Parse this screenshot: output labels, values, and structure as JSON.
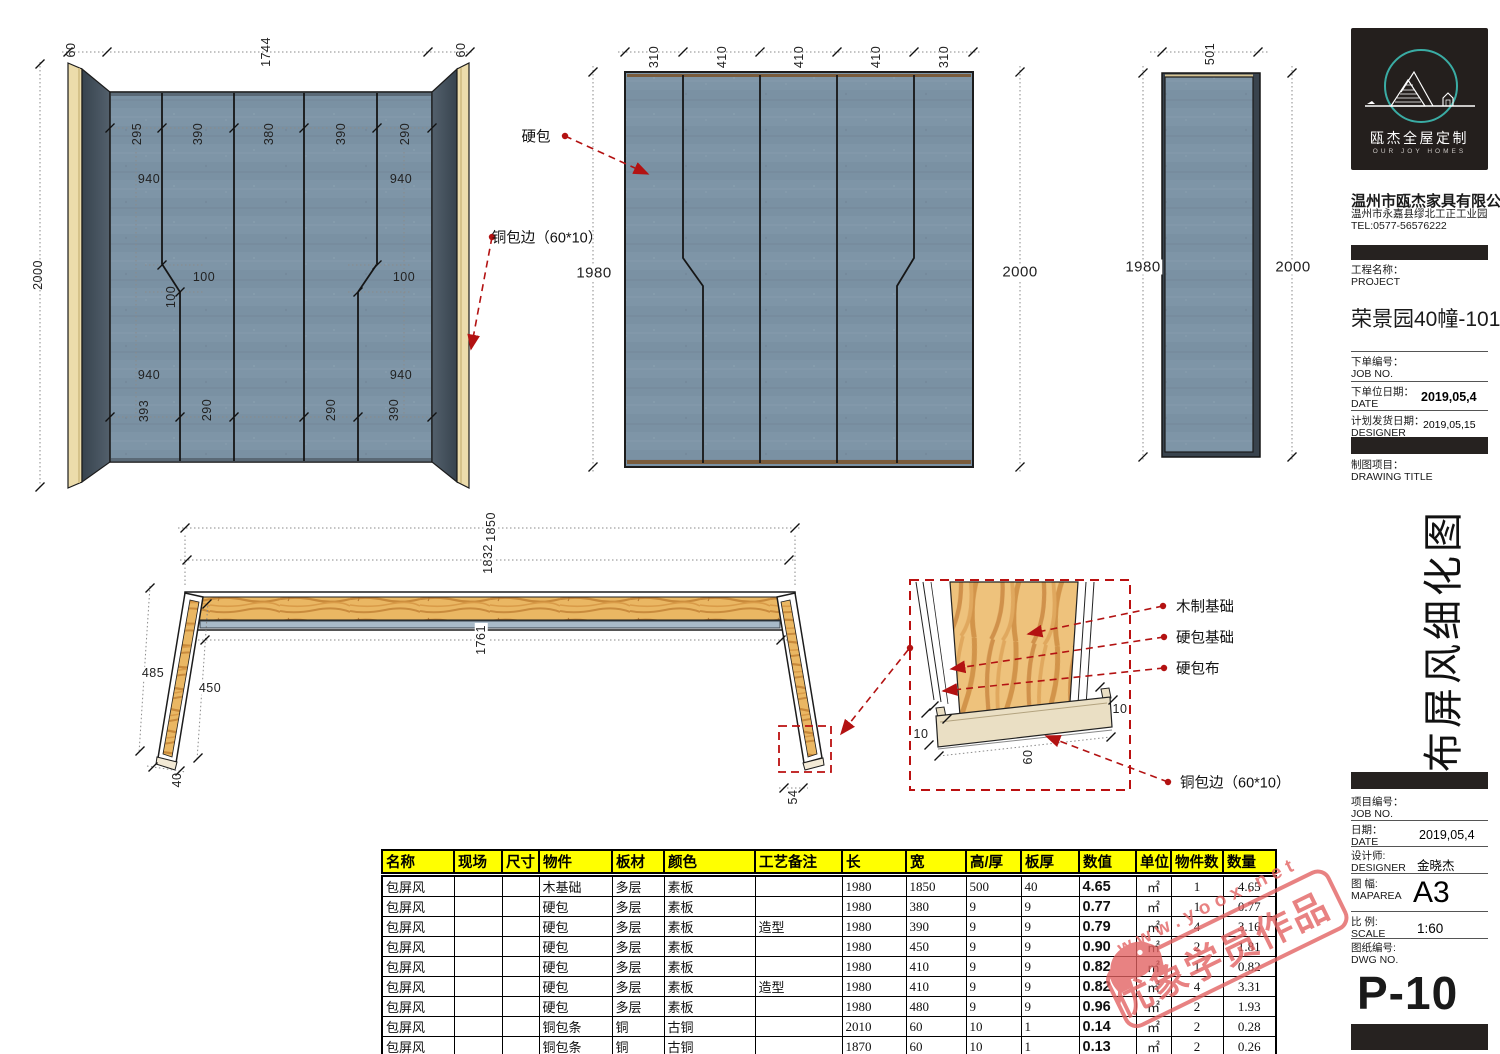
{
  "company": {
    "logo_title": "瓯杰全屋定制",
    "logo_subtitle": "OUR JOY HOMES",
    "name": "温州市瓯杰家具有限公司",
    "address": "温州市永嘉县缪北工正工业园",
    "tel": "TEL:0577-56576222"
  },
  "title_block": {
    "project_label_cn": "工程名称：",
    "project_label_en": "PROJECT",
    "project_value": "荣景园40幢-101",
    "order_no_cn": "下单编号：",
    "order_no_en": "JOB NO.",
    "order_date_cn": "下单位日期：",
    "order_date_en": "DATE",
    "order_date_value": "2019,05,4",
    "ship_date_cn": "计划发货日期：",
    "ship_date_en": "DESIGNER",
    "ship_date_value": "2019,05,15",
    "drawing_cn": "制图项目：",
    "drawing_en": "DRAWING TITLE",
    "drawing_title_vertical": "布屏风细化图",
    "job_no_cn": "项目编号：",
    "job_no_en": "JOB NO.",
    "date_cn": "日期：",
    "date_en": "DATE",
    "date_value": "2019,05,4",
    "designer_cn": "设计师:",
    "designer_en": "DESIGNER",
    "designer_value": "金晓杰",
    "map_cn": "图 幅:",
    "map_en": "MAPAREA",
    "map_value": "A3",
    "scale_cn": "比 例:",
    "scale_en": "SCALE",
    "scale_value": "1:60",
    "dwg_cn": "图纸编号:",
    "dwg_en": "DWG NO.",
    "dwg_value": "P-10"
  },
  "annotations": {
    "hard_pack": "硬包",
    "copper_edge": "铜包边（60*10）",
    "wood_base": "木制基础",
    "hard_pack_base": "硬包基础",
    "hard_pack_fabric": "硬包布"
  },
  "dims": {
    "n10": "10",
    "n40": "40",
    "n54": "54",
    "n60": "60",
    "n100": "100",
    "n290": "290",
    "n295": "295",
    "n310": "310",
    "n380": "380",
    "n390": "390",
    "n393": "393",
    "n410": "410",
    "n450": "450",
    "n485": "485",
    "n501": "501",
    "n940": "940",
    "n1744": "1744",
    "n1761": "1761",
    "n1832": "1832",
    "n1850": "1850",
    "n1980": "1980",
    "n2000": "2000"
  },
  "watermark": {
    "url": "www.yoox.net",
    "stamp_text": "优象学员作品"
  },
  "colors": {
    "fabric": "#7e95a7",
    "wing": "#3f4c59",
    "gold_edge": "#ecdcab",
    "wood": "#eab763",
    "annotation_red": "#b31212",
    "table_header": "#ffff00",
    "stamp_red": "#e2605f"
  },
  "table": {
    "headers": [
      "名称",
      "现场",
      "尺寸",
      "物件",
      "板材",
      "颜色",
      "工艺备注",
      "长",
      "宽",
      "高/厚",
      "板厚",
      "数值",
      "单位",
      "物件数",
      "数量"
    ],
    "rows": [
      [
        "包屏风",
        "",
        "",
        "木基础",
        "多层",
        "素板",
        "",
        "1980",
        "1850",
        "500",
        "40",
        "4.65",
        "㎡",
        "1",
        "4.65"
      ],
      [
        "包屏风",
        "",
        "",
        "硬包",
        "多层",
        "素板",
        "",
        "1980",
        "380",
        "9",
        "9",
        "0.77",
        "㎡",
        "1",
        "0.77"
      ],
      [
        "包屏风",
        "",
        "",
        "硬包",
        "多层",
        "素板",
        "造型",
        "1980",
        "390",
        "9",
        "9",
        "0.79",
        "㎡",
        "4",
        "3.16"
      ],
      [
        "包屏风",
        "",
        "",
        "硬包",
        "多层",
        "素板",
        "",
        "1980",
        "450",
        "9",
        "9",
        "0.90",
        "㎡",
        "2",
        "1.81"
      ],
      [
        "包屏风",
        "",
        "",
        "硬包",
        "多层",
        "素板",
        "",
        "1980",
        "410",
        "9",
        "9",
        "0.82",
        "㎡",
        "1",
        "0.82"
      ],
      [
        "包屏风",
        "",
        "",
        "硬包",
        "多层",
        "素板",
        "造型",
        "1980",
        "410",
        "9",
        "9",
        "0.82",
        "㎡",
        "4",
        "3.31"
      ],
      [
        "包屏风",
        "",
        "",
        "硬包",
        "多层",
        "素板",
        "",
        "1980",
        "480",
        "9",
        "9",
        "0.96",
        "㎡",
        "2",
        "1.93"
      ],
      [
        "包屏风",
        "",
        "",
        "铜包条",
        "铜",
        "古铜",
        "",
        "2010",
        "60",
        "10",
        "1",
        "0.14",
        "㎡",
        "2",
        "0.28"
      ],
      [
        "包屏风",
        "",
        "",
        "铜包条",
        "铜",
        "古铜",
        "",
        "1870",
        "60",
        "10",
        "1",
        "0.13",
        "㎡",
        "2",
        "0.26"
      ],
      [
        "包屏风",
        "",
        "",
        "铜包条",
        "铜",
        "古铜",
        "",
        "510",
        "60",
        "10",
        "1",
        "0.03",
        "㎡",
        "2",
        "0.07"
      ]
    ]
  }
}
